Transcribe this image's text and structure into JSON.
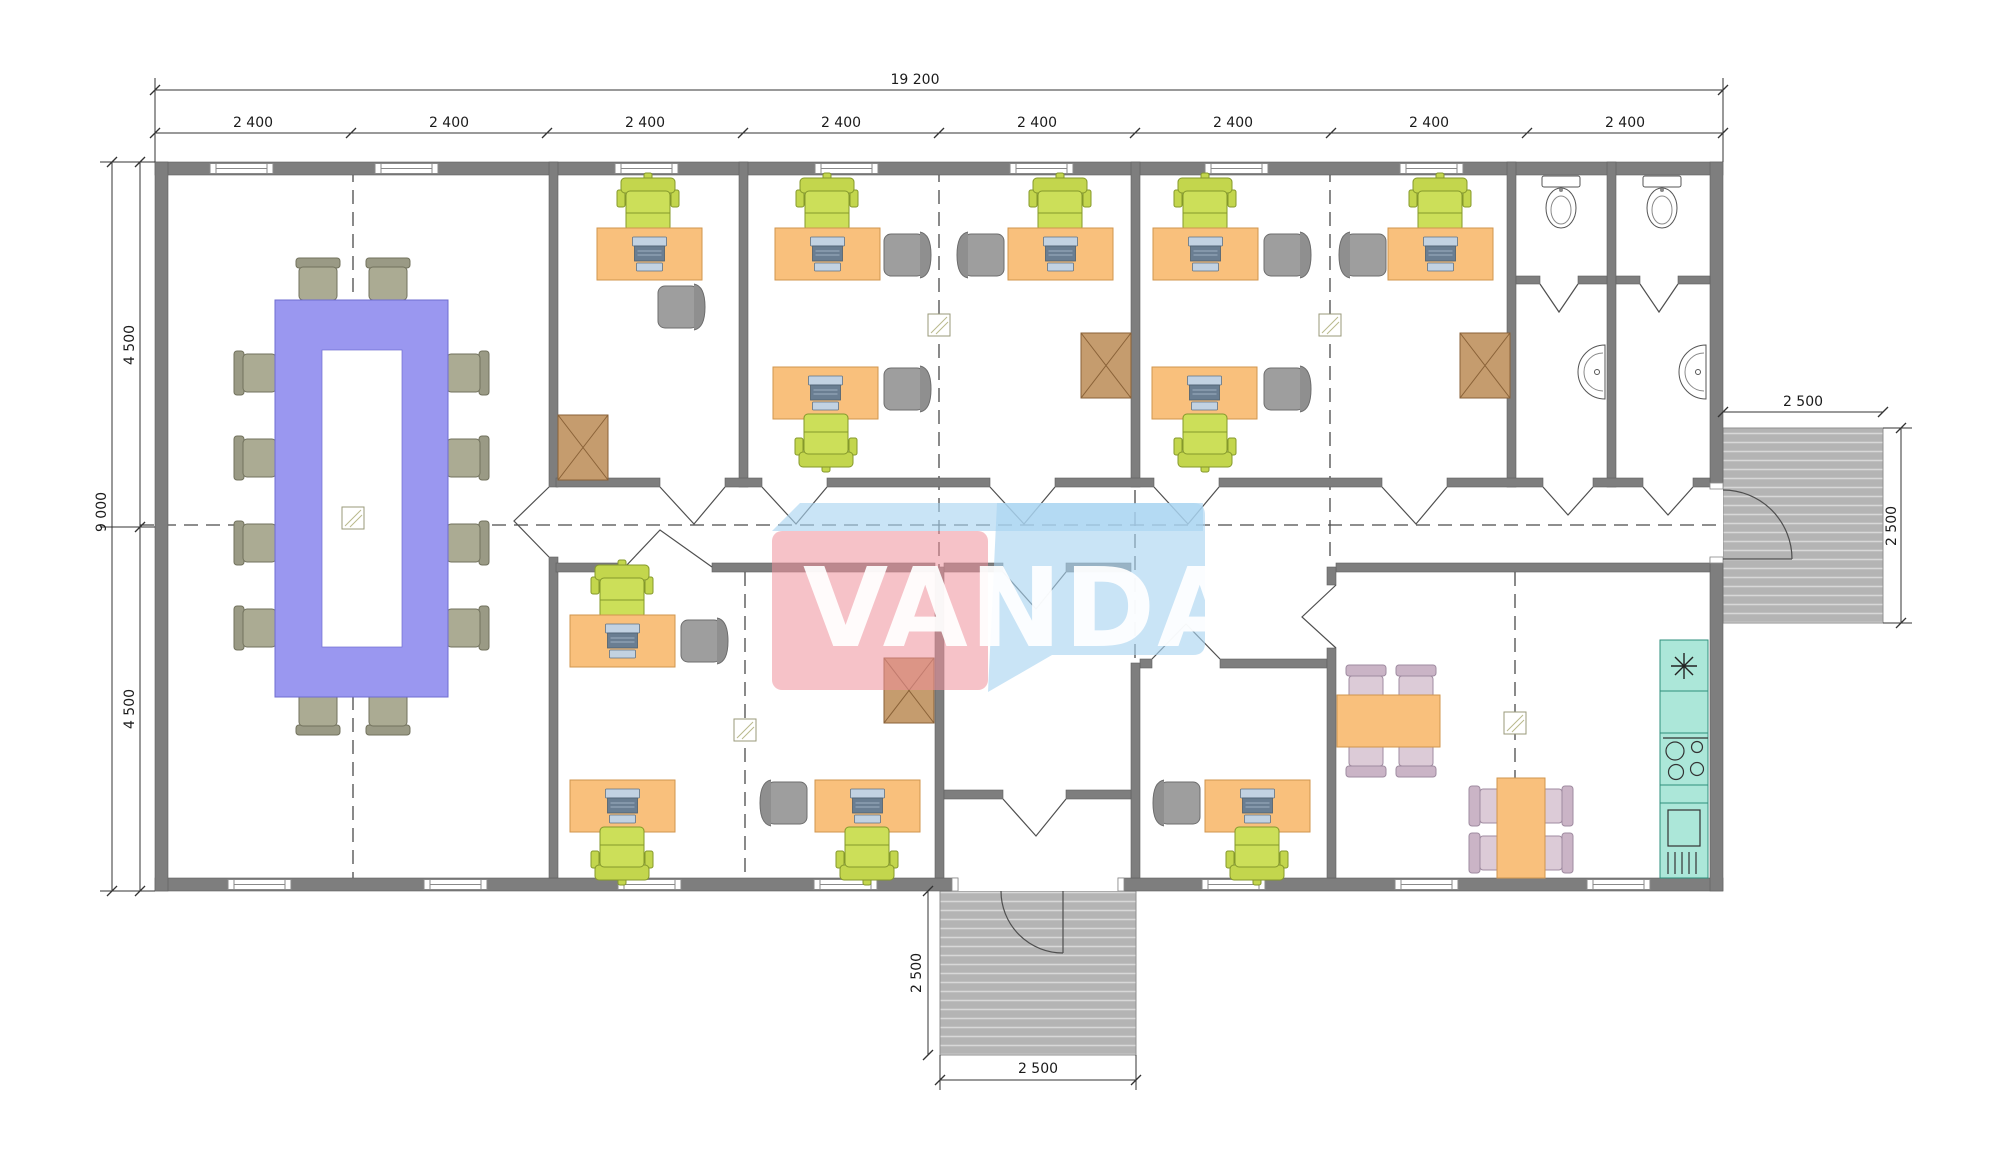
{
  "logo": {
    "text": "VANDA"
  },
  "dims": {
    "overall_width": "19 200",
    "bays": [
      "2 400",
      "2 400",
      "2 400",
      "2 400",
      "2 400",
      "2 400",
      "2 400",
      "2 400"
    ],
    "overall_height": "9 000",
    "half_upper": "4 500",
    "half_lower": "4 500",
    "porch_right_width": "2 500",
    "porch_right_depth": "2 500",
    "porch_entry_depth": "2 500",
    "porch_entry_width": "2 500"
  },
  "colors": {
    "wall": "#7e7e7e",
    "desk": "#f9c07c",
    "task_chair": "#c6d84f",
    "visitor_chair": "#9e9e9e",
    "meeting_table": "#9a97f0",
    "meeting_chair": "#abab93",
    "cabinet": "#c59c6e",
    "dining_chair": "#dccbd7",
    "kitchen_unit": "#ace7d9",
    "porch_hatch": "#b4b4b4",
    "logo_pink": "#ef8f9b",
    "logo_blue": "#a8d4f0"
  },
  "inventory": {
    "meeting_tables": 1,
    "meeting_chairs": 12,
    "desks": 11,
    "task_chairs": 11,
    "visitor_chairs": 10,
    "storage_cabinets": 4,
    "dining_tables": 2,
    "dining_chairs": 8,
    "kitchen_units": 1,
    "toilets": 2,
    "washbasins": 2,
    "porches": 2
  }
}
